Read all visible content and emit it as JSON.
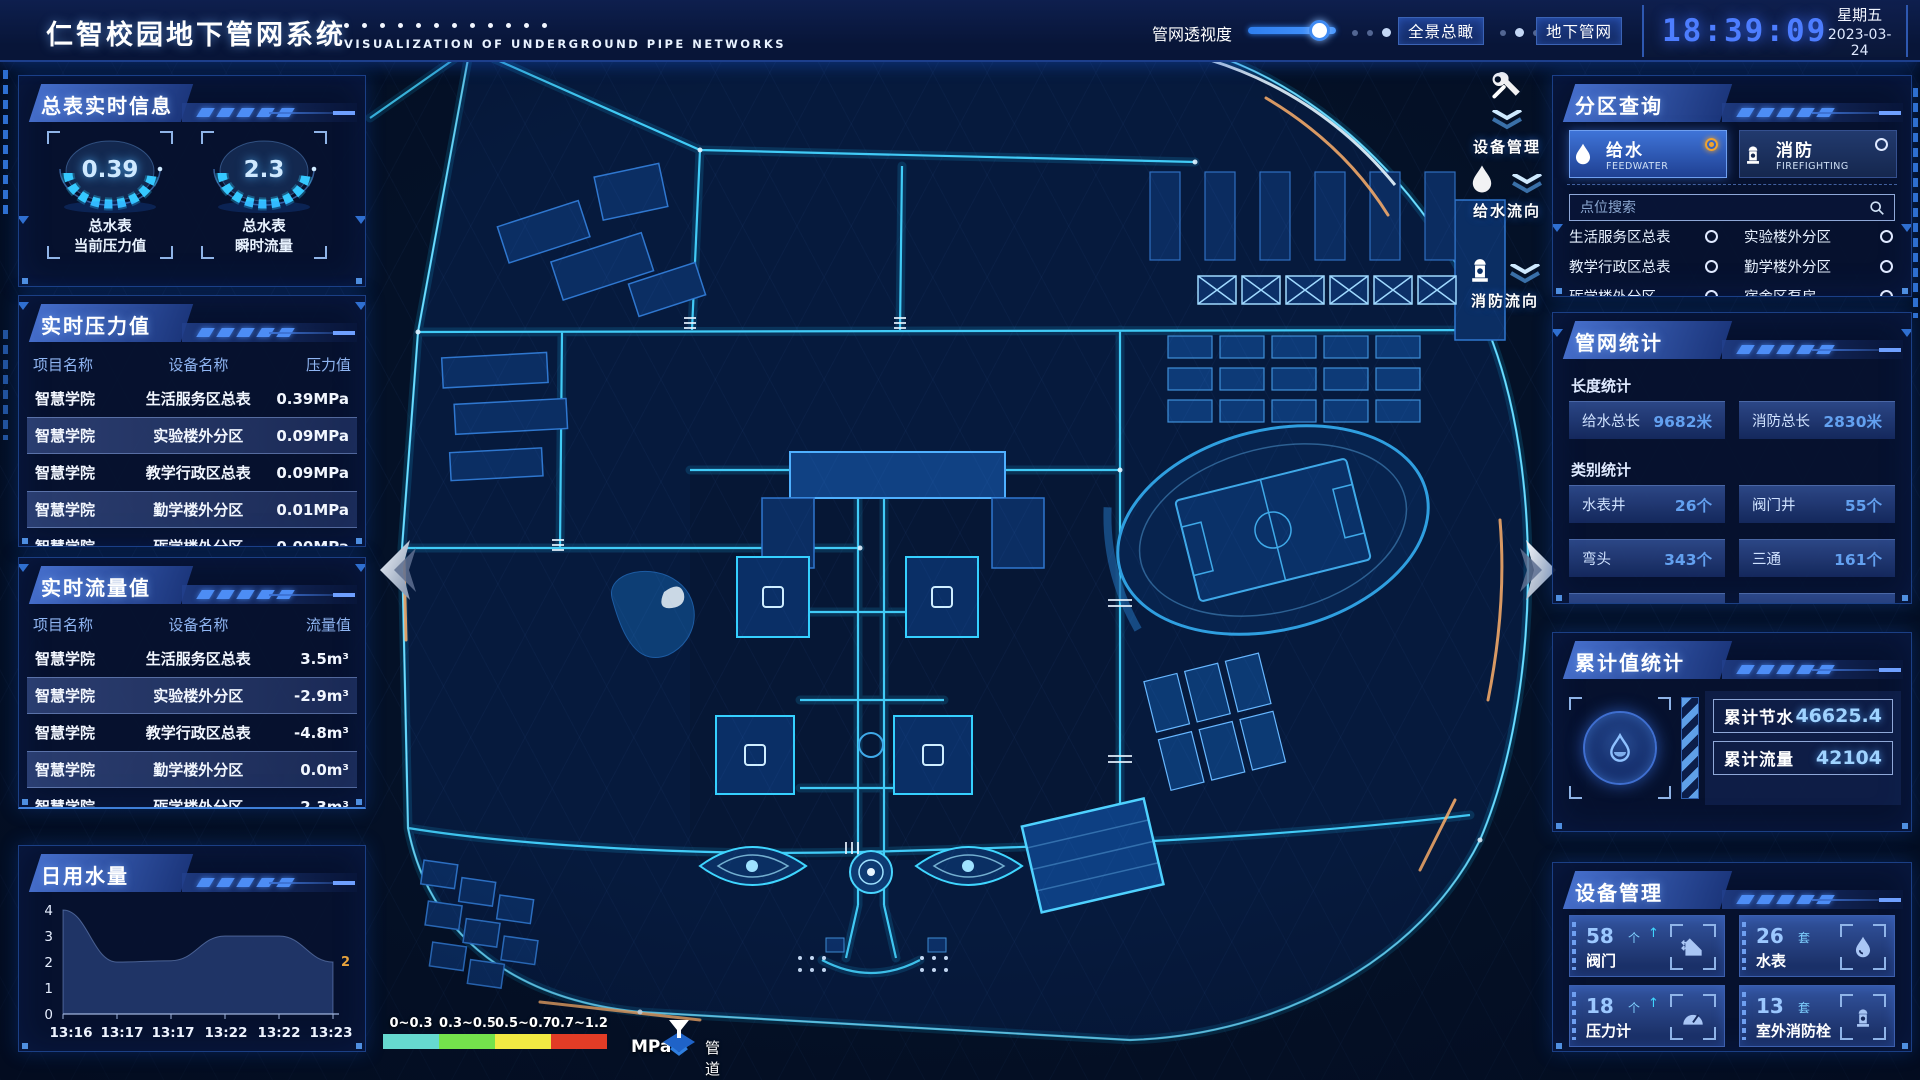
{
  "header": {
    "title": "仁智校园地下管网系统",
    "subtitle": "VISUALIZATION OF UNDERGROUND PIPE NETWORKS",
    "slider_label": "管网透视度",
    "slider_value": 82,
    "buttons": [
      {
        "label": "全景总瞰"
      },
      {
        "label": "地下管网"
      }
    ],
    "clock": {
      "time": "18:39:09",
      "weekday": "星期五",
      "date": "2023-03-24"
    }
  },
  "left": {
    "meter_info": {
      "title": "总表实时信息",
      "gauges": [
        {
          "value": "0.39",
          "line1": "总水表",
          "line2": "当前压力值"
        },
        {
          "value": "2.3",
          "line1": "总水表",
          "line2": "瞬时流量"
        }
      ]
    },
    "pressure": {
      "title": "实时压力值",
      "columns": [
        "项目名称",
        "设备名称",
        "压力值"
      ],
      "rows": [
        [
          "智慧学院",
          "生活服务区总表",
          "0.39MPa"
        ],
        [
          "智慧学院",
          "实验楼外分区",
          "0.09MPa"
        ],
        [
          "智慧学院",
          "教学行政区总表",
          "0.09MPa"
        ],
        [
          "智慧学院",
          "勤学楼外分区",
          "0.01MPa"
        ],
        [
          "智慧学院",
          "砺学楼外分区",
          "0.00MPa"
        ]
      ]
    },
    "flow": {
      "title": "实时流量值",
      "columns": [
        "项目名称",
        "设备名称",
        "流量值"
      ],
      "rows": [
        [
          "智慧学院",
          "生活服务区总表",
          "3.5m³"
        ],
        [
          "智慧学院",
          "实验楼外分区",
          "-2.9m³"
        ],
        [
          "智慧学院",
          "教学行政区总表",
          "-4.8m³"
        ],
        [
          "智慧学院",
          "勤学楼外分区",
          "0.0m³"
        ],
        [
          "智慧学院",
          "砺学楼外分区",
          "2.3m³"
        ]
      ]
    },
    "daily": {
      "title": "日用水量"
    }
  },
  "chart_data": {
    "type": "area",
    "title": "日用水量",
    "x": [
      "13:16",
      "13:17",
      "13:17",
      "13:22",
      "13:22",
      "13:23"
    ],
    "values": [
      4,
      2,
      2.05,
      3,
      3,
      2
    ],
    "yticks": [
      "4",
      "3",
      "2",
      "1",
      "0"
    ],
    "ylim": [
      0,
      4
    ],
    "last_label": "2",
    "last_label_color": "#e8a33d",
    "area_color": "#3a5da8"
  },
  "right": {
    "zone_query": {
      "title": "分区查询",
      "tabs": [
        {
          "label": "给水",
          "sub": "FEEDWATER",
          "selected": true
        },
        {
          "label": "消防",
          "sub": "FIREFIGHTING",
          "selected": false
        }
      ],
      "search_placeholder": "点位搜索",
      "items": [
        "生活服务区总表",
        "实验楼外分区",
        "教学行政区总表",
        "勤学楼外分区",
        "砺学楼外分区",
        "宿舍区泵房"
      ]
    },
    "pipe_stats": {
      "title": "管网统计",
      "groups": [
        {
          "label": "长度统计",
          "stats": [
            {
              "name": "给水总长",
              "value": "9682米"
            },
            {
              "name": "消防总长",
              "value": "2830米"
            }
          ]
        },
        {
          "label": "类别统计",
          "stats": [
            {
              "name": "水表井",
              "value": "26个"
            },
            {
              "name": "阀门井",
              "value": "55个"
            },
            {
              "name": "弯头",
              "value": "343个"
            },
            {
              "name": "三通",
              "value": "161个"
            }
          ]
        }
      ]
    },
    "cumulative": {
      "title": "累计值统计",
      "rows": [
        {
          "label": "累计节水",
          "value": "46625.4"
        },
        {
          "label": "累计流量",
          "value": "42104"
        }
      ]
    },
    "devices": {
      "title": "设备管理",
      "cards": [
        {
          "count": "58",
          "unit": "个",
          "name": "阀门",
          "icon": "valve-icon"
        },
        {
          "count": "26",
          "unit": "套",
          "name": "水表",
          "icon": "water-meter-icon"
        },
        {
          "count": "18",
          "unit": "个",
          "name": "压力计",
          "icon": "pressure-gauge-icon"
        },
        {
          "count": "13",
          "unit": "套",
          "name": "室外消防栓",
          "icon": "outdoor-hydrant-icon"
        }
      ]
    }
  },
  "map": {
    "float_buttons": [
      {
        "label": "设备管理",
        "icon": "wrench-icon"
      },
      {
        "label": "给水流向",
        "icon": "water-drop-icon"
      },
      {
        "label": "消防流向",
        "icon": "hydrant-icon"
      }
    ],
    "legend": {
      "ranges": [
        {
          "label": "0~0.3",
          "color": "#66d9d0"
        },
        {
          "label": "0.3~0.5",
          "color": "#74e24c"
        },
        {
          "label": "0.5~0.7",
          "color": "#f2ea43"
        },
        {
          "label": "0.7~1.2",
          "color": "#e23c26"
        }
      ],
      "unit": "MPa",
      "title": "管道压力"
    }
  }
}
